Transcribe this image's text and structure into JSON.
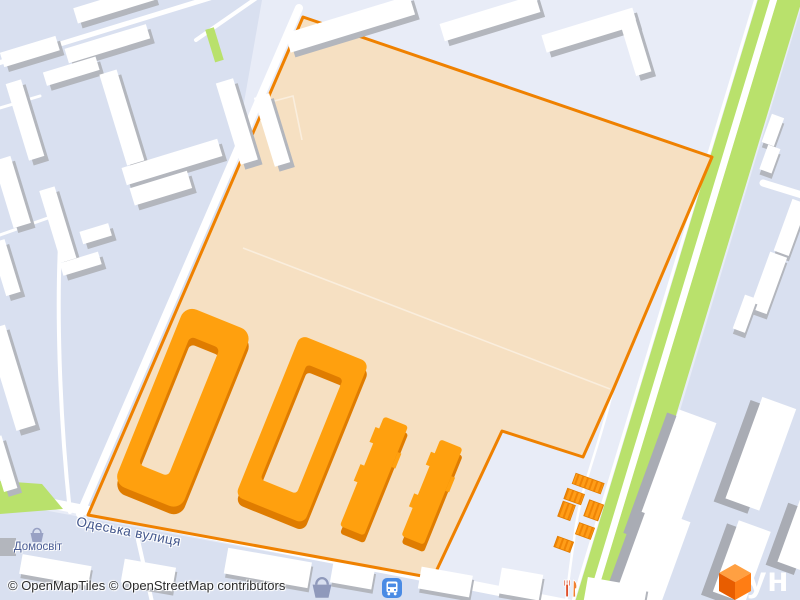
{
  "labels": {
    "street": "Одеська вулиця",
    "poi": "Домосвіт"
  },
  "attribution": {
    "text": "© OpenMapTiles © OpenStreetMap contributors"
  },
  "logo": {
    "text": "лун"
  },
  "icons": {
    "bus": "bus-icon",
    "shop_basket": "shopping-basket-icon",
    "poi_basket": "shopping-basket-icon",
    "restaurant": "restaurant-icon",
    "logo_cube": "cube-logo-icon"
  },
  "colors": {
    "bg": "#e8ecf7",
    "block": "#d9e0f0",
    "road": "#ffffff",
    "green": "#b9e16c",
    "site_fill": "#f6e0c2",
    "site_border": "#ef8100",
    "orange_top": "#ffa00e",
    "orange_side": "#df7c00",
    "garage_fill": "#ff9d18",
    "garage_stripe": "#ef8405",
    "white_bld": "#ffffff",
    "gray_side": "#b3b6bd",
    "slab_gray": "#a9acb4",
    "label_blue": "#42568c",
    "poi_blue": "#4a5c94",
    "poi_icon": "#98a1c4",
    "attribution": "#2b2b2b",
    "bus_blue": "#4a8be4",
    "restaurant_red": "#e04f2a",
    "restaurant_orange": "#f08030",
    "logo_orange": "#ff7d14"
  }
}
